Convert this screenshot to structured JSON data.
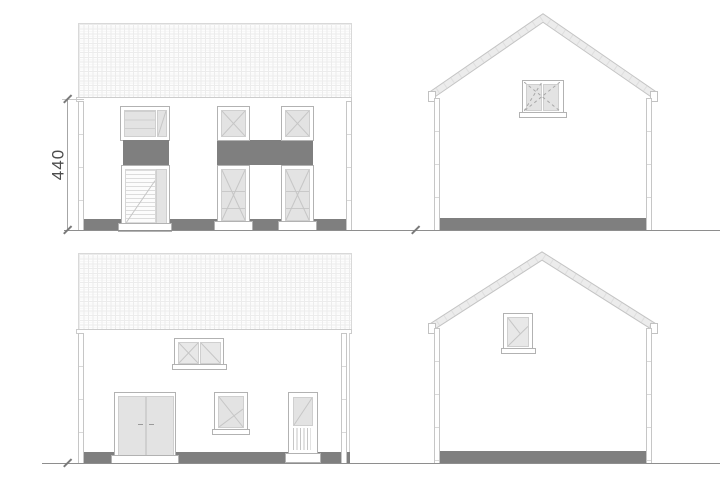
{
  "drawing": {
    "dimension_label": "440",
    "colors": {
      "paper": "#ffffff",
      "panel_dark": "#7f7f7f",
      "glass": "#e3e3e3",
      "frame_line": "#b2b2b2",
      "roof_line": "#ececec",
      "ground_line": "#8e8e8e",
      "dim_line": "#a6a6a6",
      "dim_text": "#4d4d4d"
    }
  }
}
